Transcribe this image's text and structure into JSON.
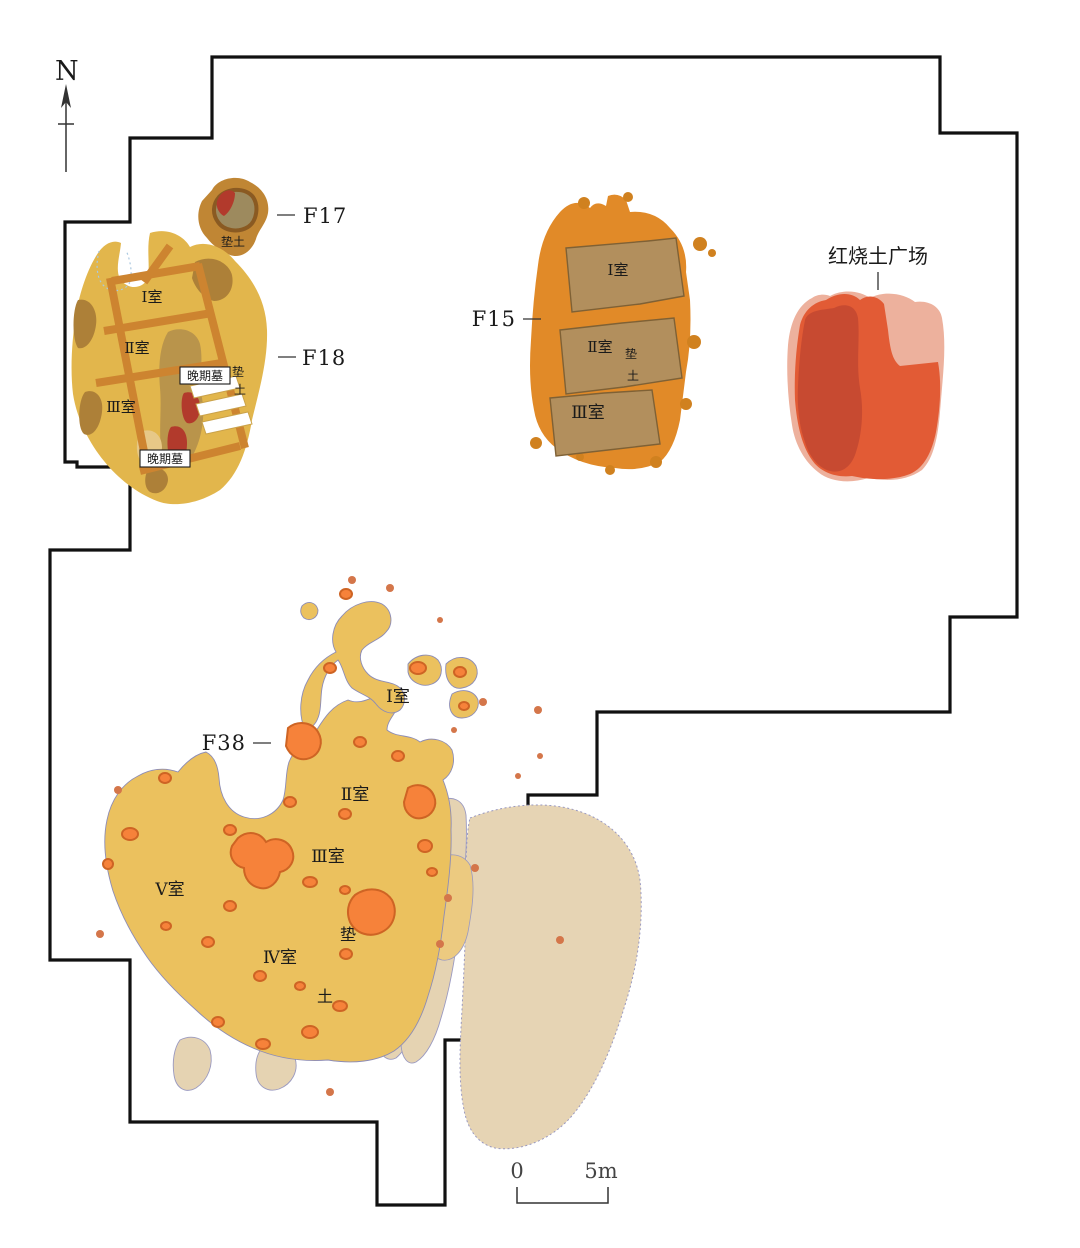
{
  "figure_type": "archaeological excavation site plan",
  "palette": {
    "boundary": "#111111",
    "f18_yellow": "#e2b64c",
    "wall_orange": "#cd8430",
    "brown_patch": "#ad8038",
    "red_patch": "#b23a2c",
    "f15_orange": "#e18a28",
    "f15_room_tan": "#b28f5d",
    "plaza_pink": "#edb19d",
    "plaza_orange": "#e25b35",
    "plaza_dark_red": "#c74a31",
    "f38_yellow": "#ebc15e",
    "burnt_patch_orange": "#f6823a",
    "beige_deposit": "#e5d3b2",
    "text": "#1a1a1a"
  },
  "north": {
    "label": "N"
  },
  "features": {
    "f17": {
      "label": "F17",
      "fill_label": "垫土"
    },
    "f18": {
      "label": "F18",
      "rooms": [
        "Ⅰ室",
        "Ⅱ室",
        "Ⅲ室"
      ],
      "tomb_label": "晚期墓",
      "fill_chars": [
        "垫",
        "土"
      ]
    },
    "f15": {
      "label": "F15",
      "rooms": [
        "Ⅰ室",
        "Ⅱ室",
        "Ⅲ室"
      ],
      "fill_chars": [
        "垫",
        "土"
      ]
    },
    "plaza": {
      "label": "红烧土广场"
    },
    "f38": {
      "label": "F38",
      "rooms": [
        "Ⅰ室",
        "Ⅱ室",
        "Ⅲ室",
        "Ⅳ室",
        "Ⅴ室"
      ],
      "fill_chars": [
        "垫",
        "土"
      ]
    }
  },
  "scale_bar": {
    "start": "0",
    "end": "5m"
  }
}
